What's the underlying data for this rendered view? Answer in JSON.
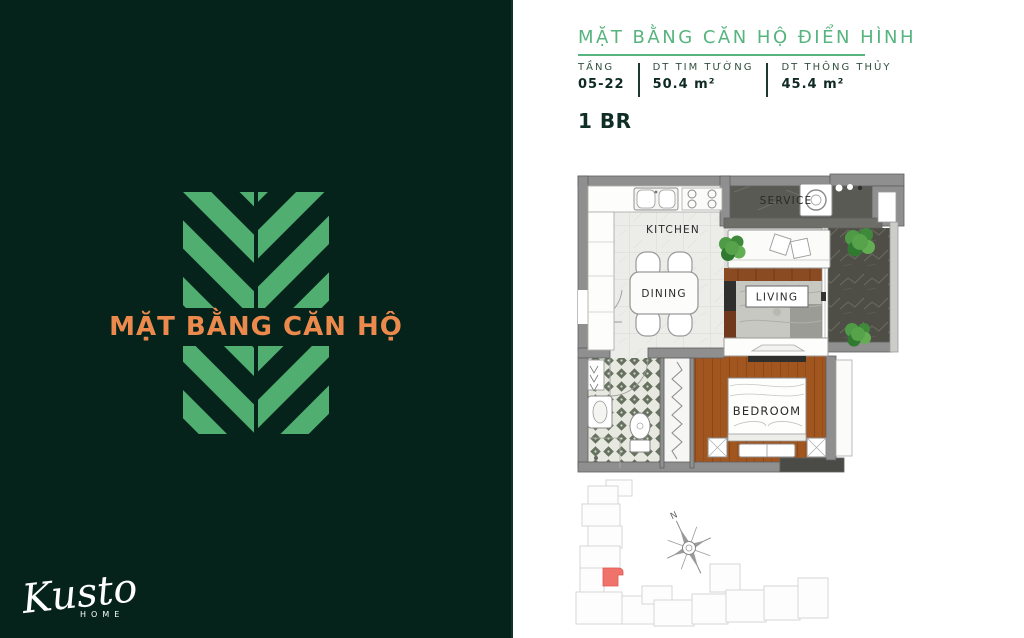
{
  "left_panel": {
    "title": "MẶT BẰNG CĂN HỘ",
    "brand_name": "Kusto",
    "brand_sub": "HOME"
  },
  "right_panel": {
    "title": "MẶT BẰNG CĂN HỘ ĐIỂN HÌNH",
    "specs": [
      {
        "label": "TẦNG",
        "value": "05-22"
      },
      {
        "label": "DT TIM TƯỜNG",
        "value": "50.4 m²"
      },
      {
        "label": "DT THÔNG THỦY",
        "value": "45.4 m²"
      }
    ],
    "unit_type": "1 BR",
    "rooms": {
      "kitchen": "KITCHEN",
      "service": "SERVICE",
      "dining": "DINING",
      "living": "LIVING",
      "bedroom": "BEDROOM"
    },
    "keyplan": {
      "compass": "N"
    }
  },
  "colors": {
    "panel_dark_green": "#05231A",
    "leaf_green": "#4FAE70",
    "accent_orange": "#EC8A4D",
    "header_green": "#57B47E",
    "keyplan_highlight_red": "#F0736B"
  }
}
